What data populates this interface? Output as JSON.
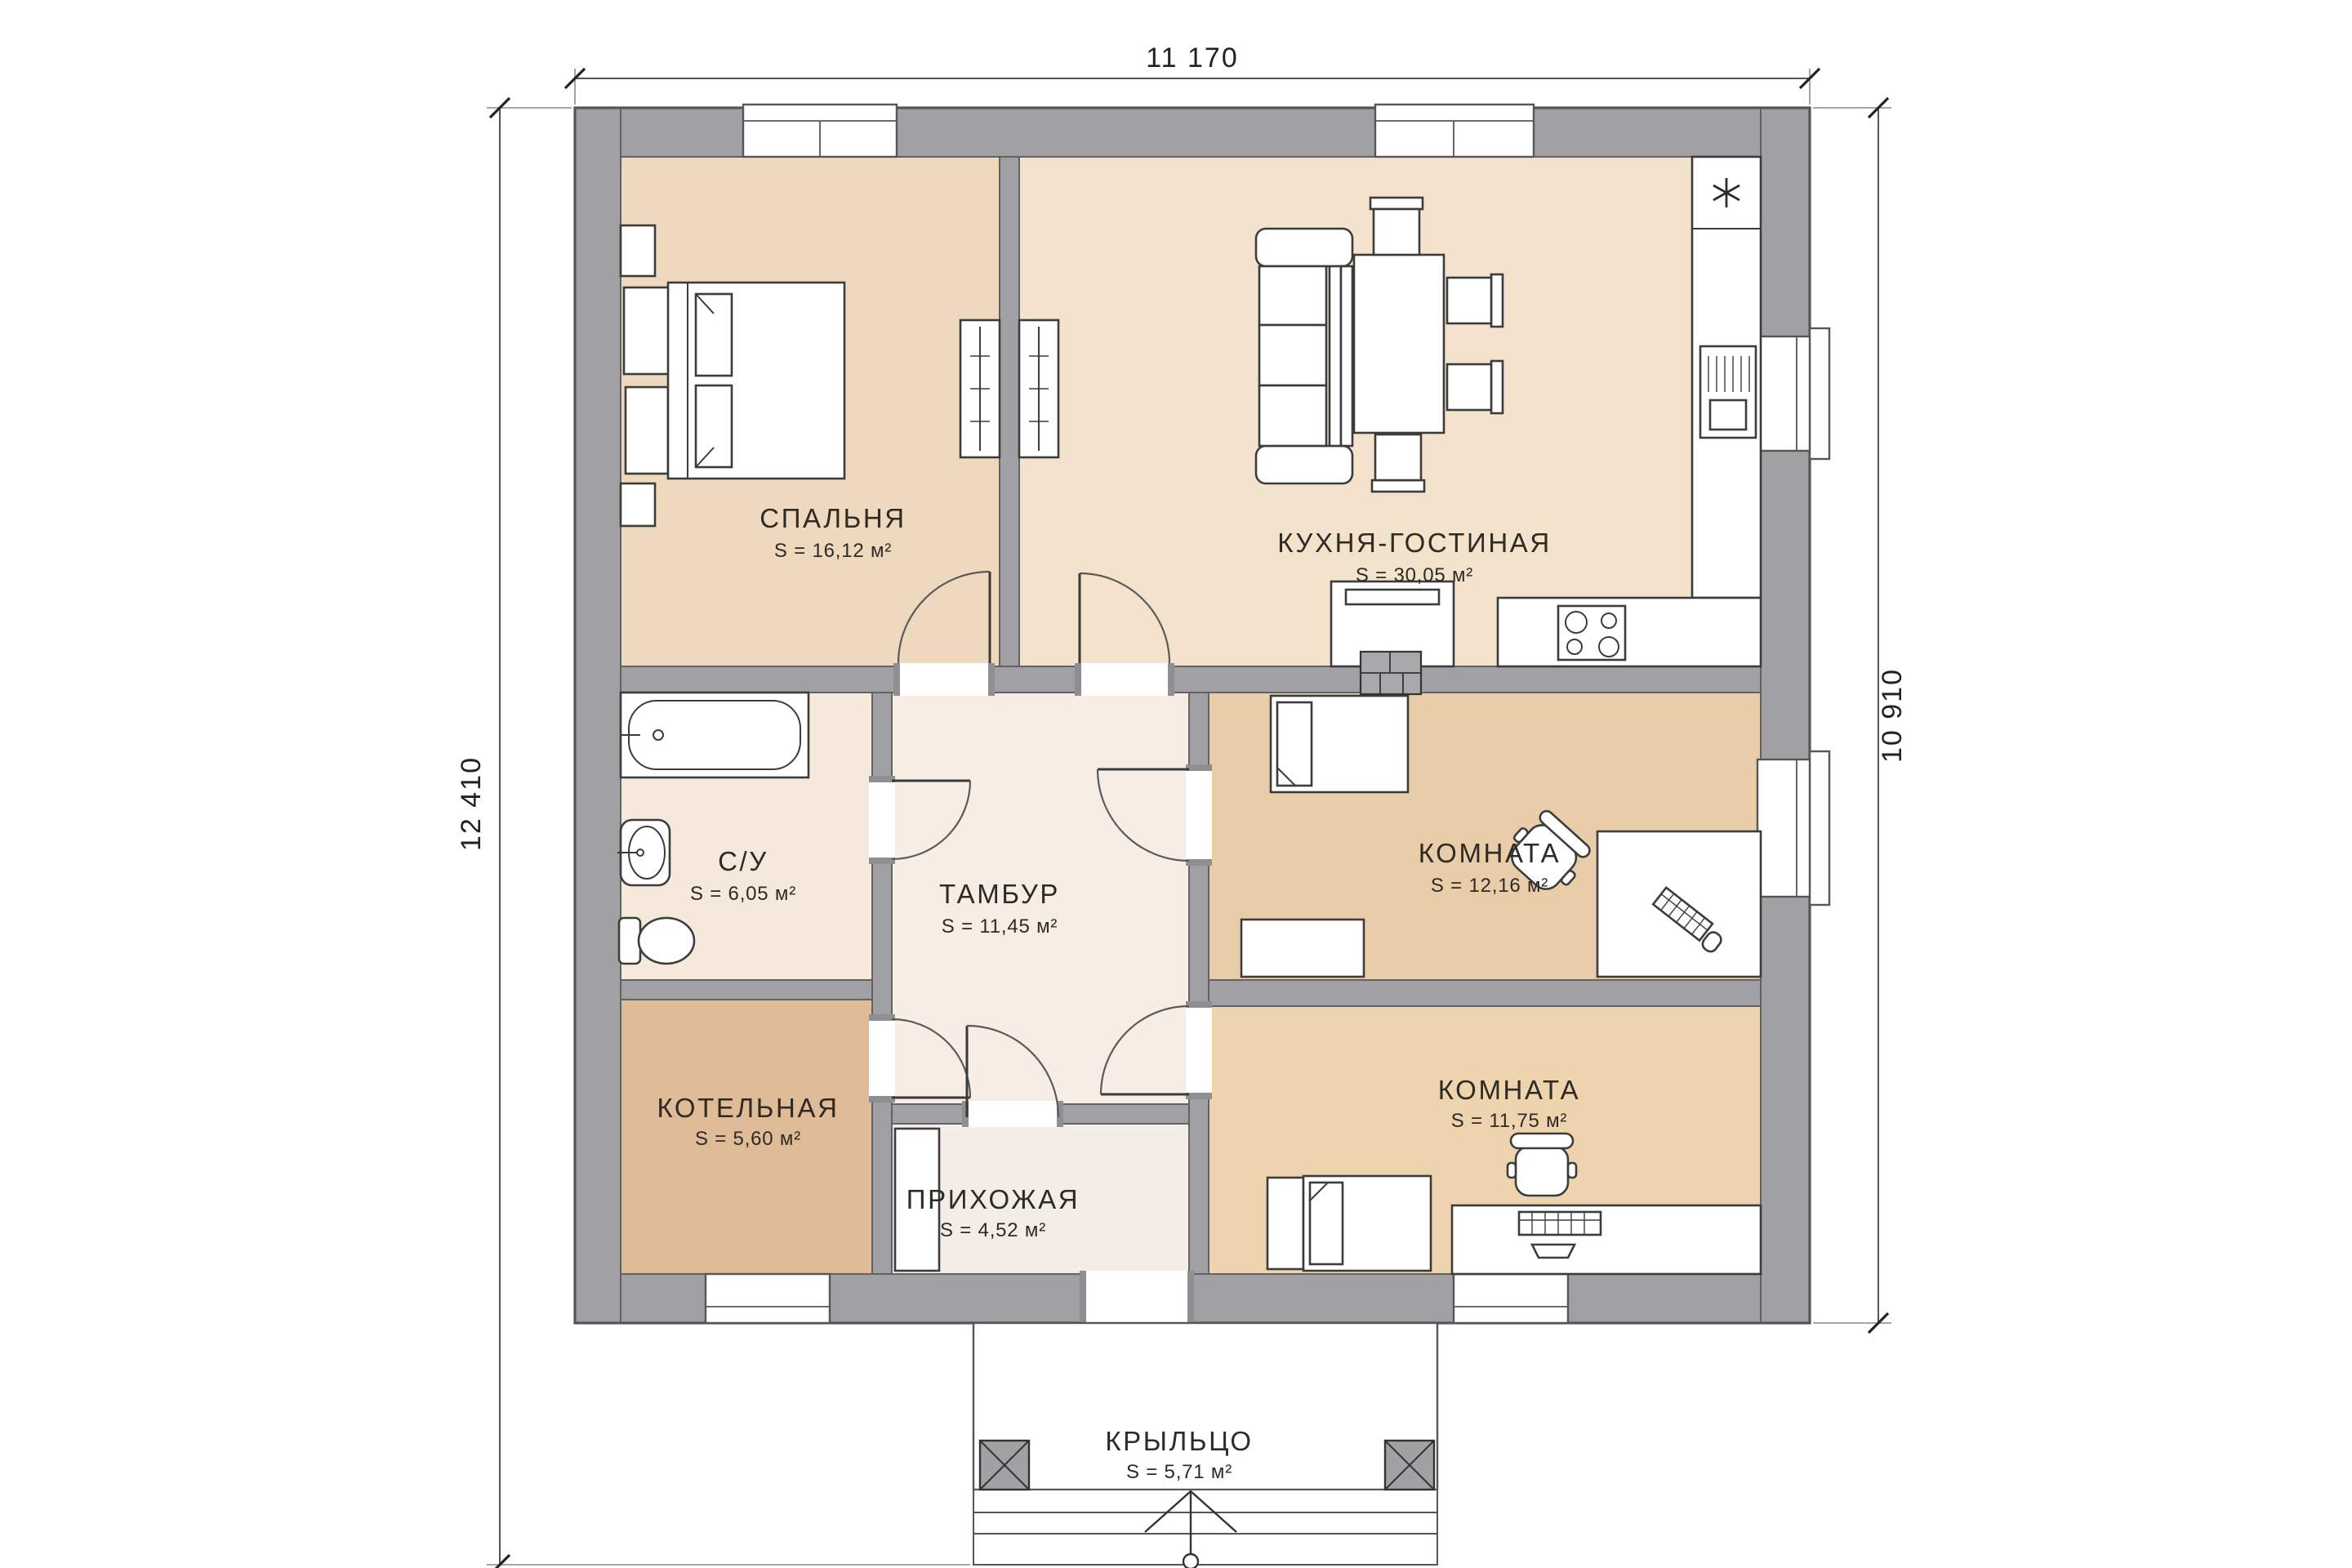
{
  "plan": {
    "title": "floor-plan",
    "dimensions": {
      "width_top": "11 170",
      "height_left": "12 410",
      "height_right": "10 910"
    },
    "rooms": [
      {
        "name": "СПАЛЬНЯ",
        "area": "S = 16,12 м²"
      },
      {
        "name": "КУХНЯ-ГОСТИНАЯ",
        "area": "S = 30,05 м²"
      },
      {
        "name": "С/У",
        "area": "S = 6,05 м²"
      },
      {
        "name": "ТАМБУР",
        "area": "S = 11,45 м²"
      },
      {
        "name": "КОМНАТА",
        "area": "S = 12,16 м²"
      },
      {
        "name": "КОТЕЛЬНАЯ",
        "area": "S = 5,60 м²"
      },
      {
        "name": "ПРИХОЖАЯ",
        "area": "S = 4,52 м²"
      },
      {
        "name": "КОМНАТА",
        "area": "S = 11,75 м²"
      },
      {
        "name": "КРЫЛЬЦО",
        "area": "S = 5,71 м²"
      }
    ],
    "colors": {
      "wall": "#a1a1a4",
      "bedroom": "#eed8be",
      "kitchen_living": "#f4e3cc",
      "bathroom": "#f5e9dc",
      "vestibule": "#f7ede4",
      "room_middle": "#e9cda8",
      "boiler": "#dfbc97",
      "hallway": "#f4ede7",
      "room_bottom": "#eed3af"
    }
  }
}
